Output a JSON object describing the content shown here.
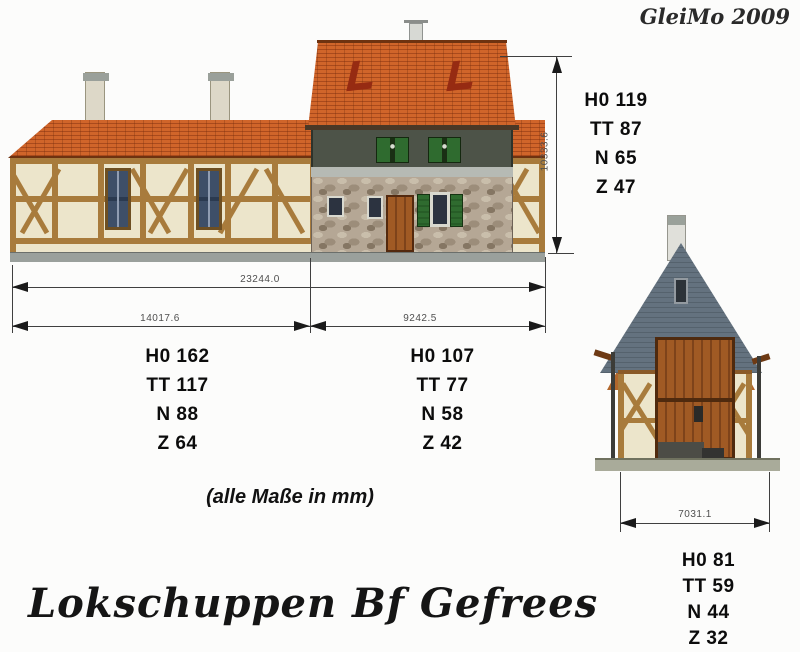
{
  "signature": "GleiMo 2009",
  "title": "Lokschuppen Bf Gefrees",
  "note": "(alle Maße in mm)",
  "dims": {
    "overall": "23244.0",
    "shed": "14017.6",
    "house": "9242.5",
    "height": "10333.6",
    "end_width": "7031.1"
  },
  "scales": {
    "height": [
      "H0 119",
      "TT 87",
      "N 65",
      "Z 47"
    ],
    "shed": [
      "H0 162",
      "TT 117",
      "N 88",
      "Z 64"
    ],
    "house": [
      "H0 107",
      "TT 77",
      "N 58",
      "Z 42"
    ],
    "end": [
      "H0 81",
      "TT 59",
      "N 44",
      "Z 32"
    ]
  },
  "colors": {
    "roof_tile": "#c2571f",
    "slate_roof": "#5d6b7a",
    "timber": "#a87b3c",
    "infill": "#ece5cb",
    "stone": "#b5a795",
    "door_brown": "#8a4a1e",
    "shutter_green": "#2f6b2f",
    "dimension_line": "#3f3f3f",
    "background": "#fcfcfb"
  }
}
